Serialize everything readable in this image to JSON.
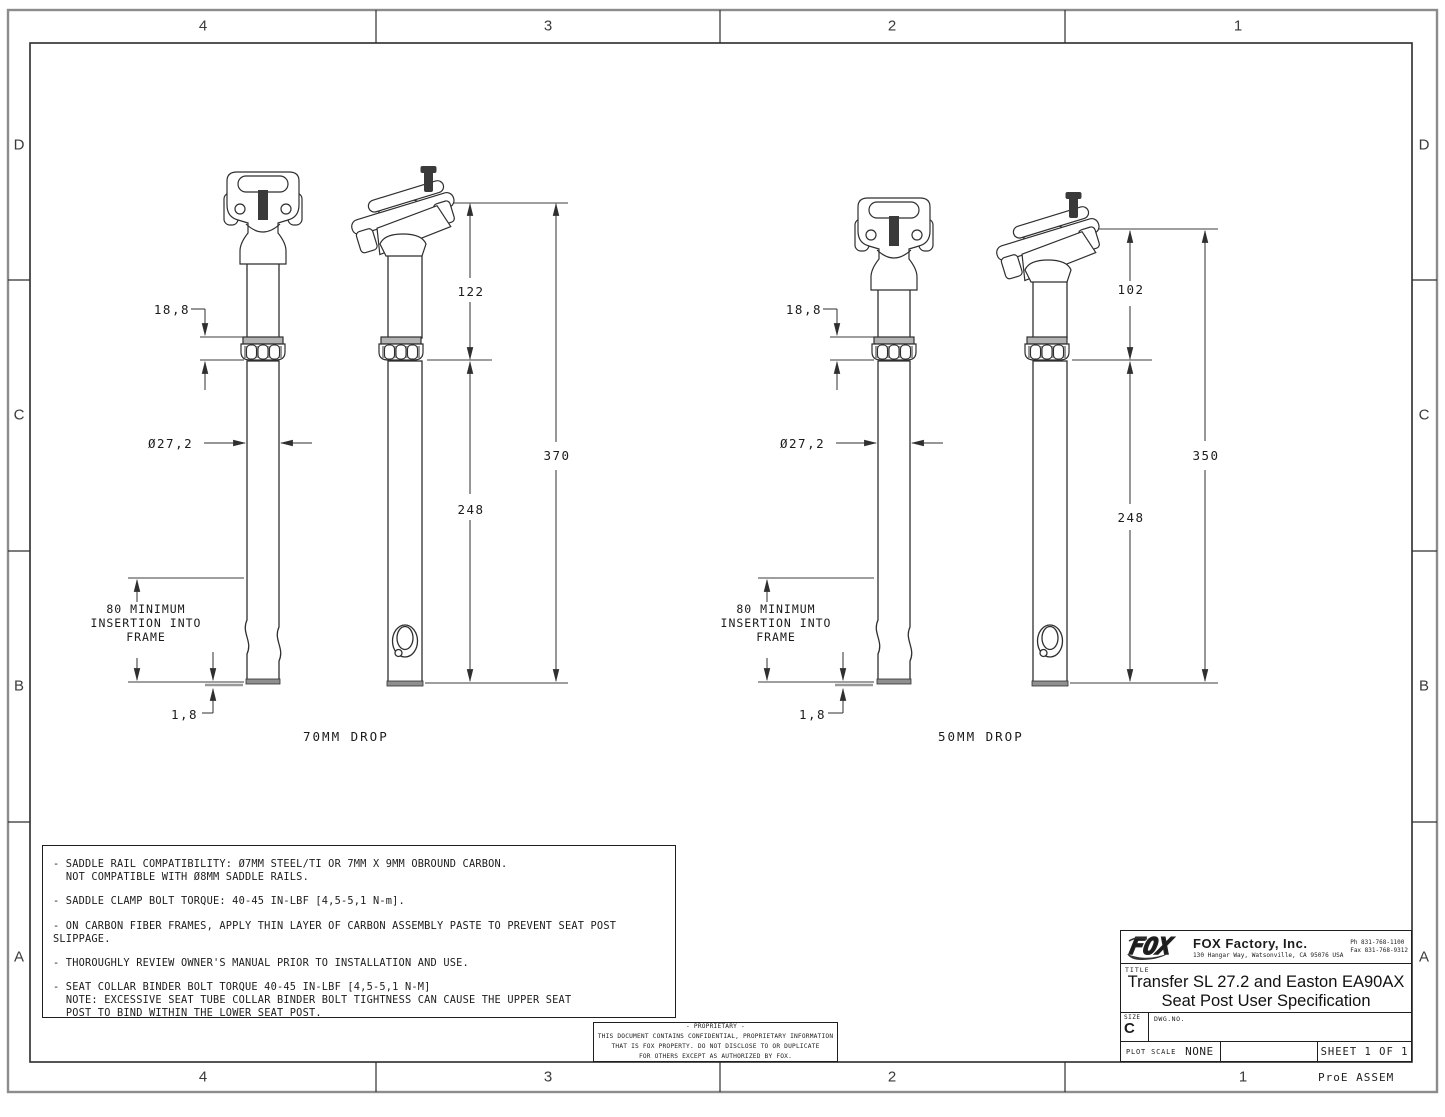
{
  "drawing": {
    "zones": {
      "columns": [
        "4",
        "3",
        "2",
        "1"
      ],
      "rows": [
        "D",
        "C",
        "B",
        "A"
      ]
    },
    "views": {
      "left": {
        "drop_label": "70MM DROP",
        "dim_head_to_collar": "122",
        "dim_collar_to_tip": "248",
        "dim_overall": "370",
        "dim_collar_height": "18,8",
        "dim_diameter": "Ø27,2",
        "insertion_line1": "80 MINIMUM",
        "insertion_line2": "INSERTION INTO",
        "insertion_line3": "FRAME",
        "dim_tip_gap": "1,8"
      },
      "right": {
        "drop_label": "50MM DROP",
        "dim_head_to_collar": "102",
        "dim_collar_to_tip": "248",
        "dim_overall": "350",
        "dim_collar_height": "18,8",
        "dim_diameter": "Ø27,2",
        "insertion_line1": "80 MINIMUM",
        "insertion_line2": "INSERTION INTO",
        "insertion_line3": "FRAME",
        "dim_tip_gap": "1,8"
      }
    },
    "notes": [
      "- SADDLE RAIL COMPATIBILITY: Ø7MM STEEL/TI OR 7MM X 9MM OBROUND CARBON.\n  NOT COMPATIBLE WITH Ø8MM SADDLE RAILS.",
      "- SADDLE CLAMP BOLT TORQUE: 40-45 IN-LBF [4,5-5,1 N-m].",
      "- ON CARBON FIBER FRAMES, APPLY THIN LAYER OF CARBON ASSEMBLY PASTE TO PREVENT SEAT POST SLIPPAGE.",
      "- THOROUGHLY REVIEW OWNER'S MANUAL PRIOR TO INSTALLATION AND USE.",
      "- SEAT COLLAR BINDER BOLT TORQUE 40-45 IN-LBF [4,5-5,1 N-M]\n  NOTE: EXCESSIVE SEAT TUBE COLLAR BINDER BOLT TIGHTNESS CAN CAUSE THE UPPER SEAT\n  POST TO BIND WITHIN THE LOWER SEAT POST.",
      "PROPRIETARY_NOTE_BELOW"
    ],
    "proprietary": "- PROPRIETARY -\nTHIS DOCUMENT CONTAINS CONFIDENTIAL, PROPRIETARY INFORMATION\nTHAT IS FOX PROPERTY.  DO NOT DISCLOSE TO OR DUPLICATE\nFOR OTHERS EXCEPT AS AUTHORIZED BY FOX.",
    "title_block": {
      "logo_text": "FOX",
      "company": "FOX Factory, Inc.",
      "address": "130 Hangar Way, Watsonville, CA 95076 USA",
      "phone": "Ph 831-768-1100",
      "fax": "Fax 831-768-9312",
      "title_label": "TITLE",
      "title_line1": "Transfer SL 27.2 and Easton EA90AX",
      "title_line2": "Seat Post User Specification",
      "size_label": "SIZE",
      "size_value": "C",
      "dwg_label": "DWG.NO.",
      "plot_scale_label": "PLOT SCALE",
      "plot_scale_value": "NONE",
      "sheet": "SHEET 1 OF 1"
    },
    "stamp": "ProE ASSEM"
  }
}
